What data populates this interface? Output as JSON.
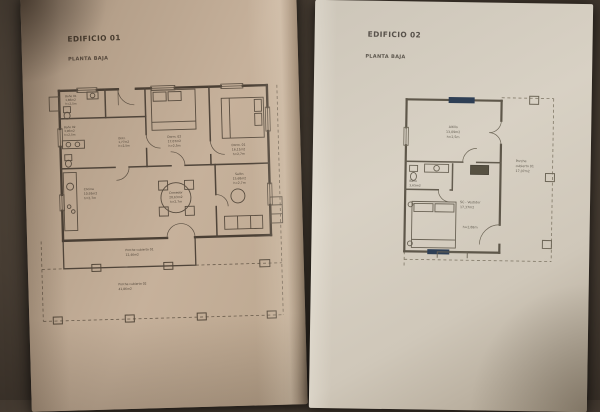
{
  "colors": {
    "paper_left": "#c0ab95",
    "paper_right": "#d3cbbe",
    "ink_left": "#4e4337",
    "ink_right": "#66604f",
    "highlight_mark": "#2e3f55",
    "background": "#2b2520"
  },
  "sheet1": {
    "title": "EDIFICIO 01",
    "subtitle": "PLANTA BAJA",
    "labels": {
      "bano01": {
        "name": "Baño 01",
        "area": "1,86m2",
        "h": "h=2,5m"
      },
      "bano02": {
        "name": "Baño 02",
        "area": "3,96m2",
        "h": "h=2,5m"
      },
      "distr": {
        "name": "Distr.",
        "area": "1,77m2",
        "h": "h=2,5m"
      },
      "dorm02": {
        "name": "Dorm. 02",
        "area": "17,07m2",
        "h": "h=2,5m"
      },
      "dorm01": {
        "name": "Dorm. 01",
        "area": "16,11m2",
        "h": "h=2,7m"
      },
      "cocina": {
        "name": "Cocina",
        "area": "10,93m2",
        "h": "h=2,7m"
      },
      "comedor": {
        "name": "Comedor",
        "area": "20,63m2",
        "h": "h=2,7m"
      },
      "salon": {
        "name": "Salón",
        "area": "15,68m2",
        "h": "h=2,7m"
      },
      "porche1": {
        "name": "Porche cubierto 01",
        "area": "12,46m2"
      },
      "porche2": {
        "name": "Porche cubierto 02",
        "area": "41,86m2"
      }
    }
  },
  "sheet2": {
    "title": "EDIFICIO 02",
    "subtitle": "PLANTA BAJA",
    "labels": {
      "altillo": {
        "name": "Altillo",
        "area": "13,09m2",
        "h": "h=2,5m"
      },
      "bano": {
        "name": "Baño",
        "area": "3,65m2"
      },
      "principal": {
        "name": "SC - Vestidor",
        "area": "17,37m2",
        "h": "h=2,88m"
      },
      "porche": {
        "line1": "Porche",
        "line2": "cubierto 01",
        "area": "17,07m2"
      }
    }
  }
}
